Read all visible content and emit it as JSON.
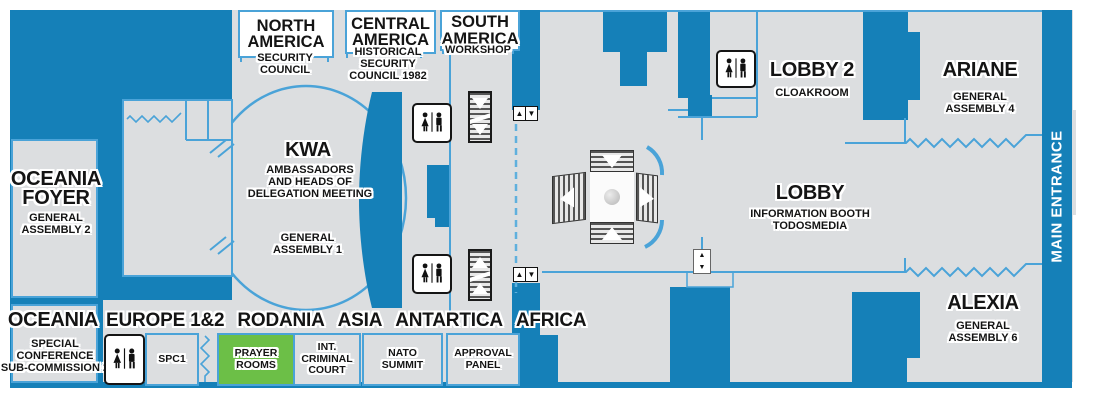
{
  "title": "Conference venue floor plan",
  "colors": {
    "wall_blue": "#1580b8",
    "floor_gray": "#dcdee0",
    "accent_blue": "#4aa3d8",
    "prayer_green": "#6cbf47",
    "callout_white": "#ffffff"
  },
  "callouts": {
    "north_america": {
      "title": "NORTH\nAMERICA",
      "subtitle": "SECURITY\nCOUNCIL"
    },
    "central_america": {
      "title": "CENTRAL\nAMERICA",
      "subtitle": "HISTORICAL\nSECURITY\nCOUNCIL 1982"
    },
    "south_america": {
      "title": "SOUTH\nAMERICA",
      "subtitle": "WORKSHOP"
    }
  },
  "rooms": {
    "kwa": {
      "title": "KWA",
      "subtitle": "AMBASSADORS\nAND HEADS OF\nDELEGATION MEETING",
      "detail": "GENERAL\nASSEMBLY 1"
    },
    "oceania_foyer": {
      "title": "OCEANIA\nFOYER",
      "detail": "GENERAL\nASSEMBLY 2"
    },
    "oceania": {
      "title": "OCEANIA",
      "detail": "SPECIAL\nCONFERENCE\nSUB-COMMISSION 2"
    },
    "lobby2": {
      "title": "LOBBY 2",
      "detail": "CLOAKROOM"
    },
    "ariane": {
      "title": "ARIANE",
      "detail": "GENERAL\nASSEMBLY 4"
    },
    "lobby": {
      "title": "LOBBY",
      "detail": "INFORMATION BOOTH\nTODOSMEDIA"
    },
    "alexia": {
      "title": "ALEXIA",
      "detail": "GENERAL\nASSEMBLY 6"
    }
  },
  "corridor_regions": [
    "EUROPE 1&2",
    "RODANIA",
    "ASIA",
    "ANTARTICA",
    "AFRICA"
  ],
  "small_rooms": {
    "spc1": "SPC1",
    "prayer_rooms": "PRAYER\nROOMS",
    "int_criminal_court": "INT.\nCRIMINAL\nCOURT",
    "nato_summit": "NATO\nSUMMIT",
    "approval_panel": "APPROVAL\nPANEL"
  },
  "entrance": {
    "label": "MAIN ENTRANCE"
  },
  "glyphs": {
    "up": "▲",
    "down": "▼"
  },
  "icons": {
    "restroom": "woman-man pictogram",
    "escalator_down": "striped ramp with down arrows",
    "escalator_up": "striped ramp with up arrows",
    "elevator_buttons": "up/down call buttons"
  }
}
